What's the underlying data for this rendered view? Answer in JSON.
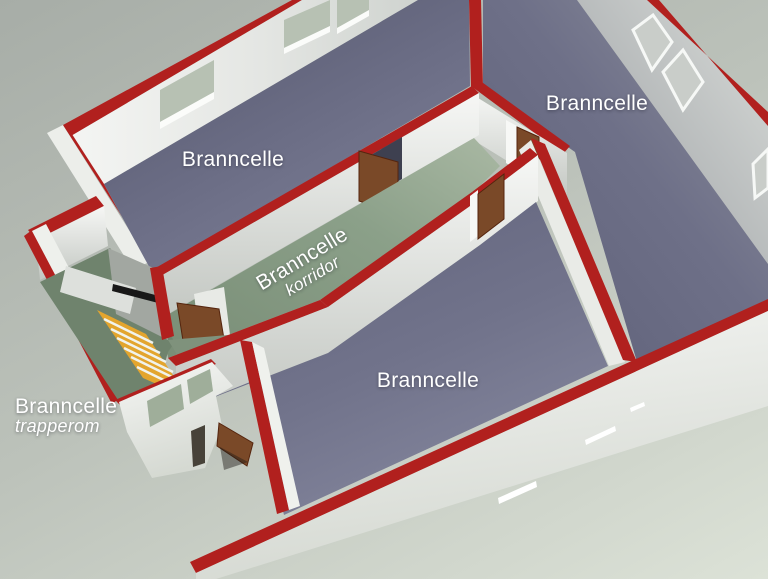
{
  "rooms": [
    {
      "id": "room-top-left",
      "label": "Branncelle",
      "sublabel": ""
    },
    {
      "id": "room-top-right",
      "label": "Branncelle",
      "sublabel": ""
    },
    {
      "id": "corridor",
      "label": "Branncelle",
      "sublabel": "korridor"
    },
    {
      "id": "room-bottom",
      "label": "Branncelle",
      "sublabel": ""
    },
    {
      "id": "stairwell",
      "label": "Branncelle",
      "sublabel": "trapperom"
    }
  ],
  "colors": {
    "fire_wall_red": "#b1201e",
    "wall_white": "#f2f3f1",
    "room_floor_dark": "#5b5d74",
    "room_floor_light": "#82849b",
    "corridor_floor": "#8ba089",
    "stairwell_floor": "#6f836d",
    "stair_yellow": "#e3a52e",
    "door_brown": "#7a4928",
    "window_glass_green": "#b7c1b3",
    "background_top": "#a7ada7",
    "background_bottom": "#dce2d7",
    "label_text": "#ffffff"
  }
}
